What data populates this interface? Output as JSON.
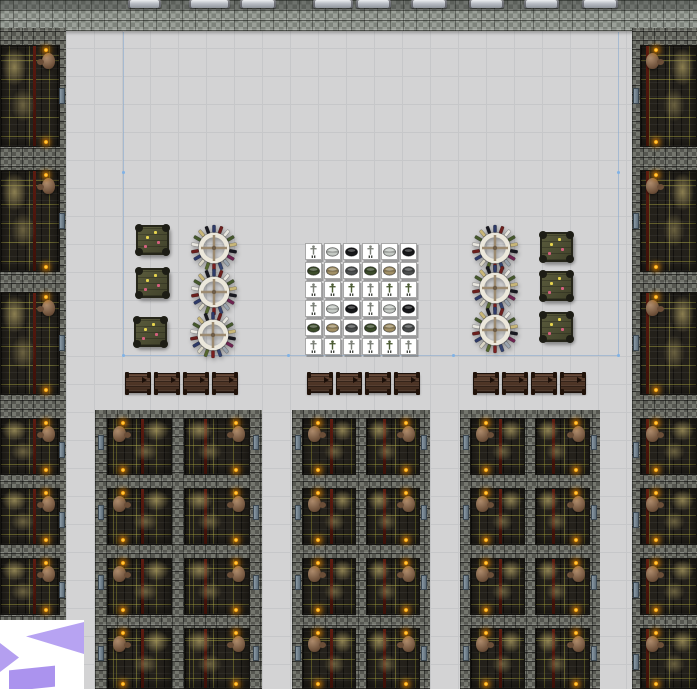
{
  "scene": {
    "width": 697,
    "height": 689,
    "label": "top-down dungeon colony map view"
  },
  "floor": {
    "color": "#d3d3d4",
    "grid_color": "#c6c7c9",
    "grid_step": 28
  },
  "top_wall": {
    "height": 31,
    "dark_cap_height": 10,
    "beams": [
      [
        128,
        33
      ],
      [
        189,
        41
      ],
      [
        240,
        36
      ],
      [
        313,
        40
      ],
      [
        356,
        35
      ],
      [
        411,
        36
      ],
      [
        469,
        35
      ],
      [
        524,
        35
      ],
      [
        582,
        36
      ]
    ]
  },
  "strips": {
    "left": {
      "x": 0,
      "w": 66,
      "interior_x": 0,
      "interior_w": 60,
      "door_x": 59,
      "pot_side": "right",
      "stripe_pct": 56
    },
    "right": {
      "x": 632,
      "w": 65,
      "interior_x": 640,
      "interior_w": 57,
      "door_x": 633,
      "pot_side": "left",
      "stripe_pct": 9
    },
    "rooms": [
      [
        45,
        102
      ],
      [
        170,
        102
      ],
      [
        292,
        103
      ],
      [
        418,
        57
      ],
      [
        488,
        57
      ],
      [
        558,
        57
      ],
      [
        628,
        61
      ]
    ]
  },
  "blocks": {
    "top": 410,
    "rows": [
      [
        418,
        57
      ],
      [
        488,
        57
      ],
      [
        558,
        57
      ],
      [
        628,
        61
      ]
    ],
    "list": [
      {
        "x": 95,
        "w": 167,
        "cols": [
          [
            107,
            65
          ],
          [
            184,
            66
          ]
        ]
      },
      {
        "x": 292,
        "w": 138,
        "cols": [
          [
            302,
            54
          ],
          [
            366,
            54
          ]
        ]
      },
      {
        "x": 460,
        "w": 140,
        "cols": [
          [
            470,
            55
          ],
          [
            535,
            55
          ]
        ]
      }
    ]
  },
  "furniture": {
    "square_tables": [
      [
        152,
        240
      ],
      [
        152,
        283
      ],
      [
        150,
        332
      ],
      [
        556,
        247
      ],
      [
        556,
        286
      ],
      [
        556,
        327
      ]
    ],
    "square_table_size": [
      33,
      30
    ],
    "square_table_dots": [
      [
        0.58,
        0.16,
        "#e6d44e"
      ],
      [
        0.3,
        0.33,
        "#e6d44e"
      ],
      [
        0.68,
        0.55,
        "#d4607e"
      ],
      [
        0.24,
        0.7,
        "#d4607e"
      ]
    ],
    "round_tables": [
      [
        214,
        248
      ],
      [
        214,
        292
      ],
      [
        213,
        335
      ],
      [
        495,
        248
      ],
      [
        495,
        288
      ],
      [
        495,
        330
      ]
    ],
    "round_table_size": 48,
    "benches": {
      "y": 373,
      "w": 26,
      "h": 20,
      "xs": [
        125,
        154,
        183,
        212,
        307,
        336,
        365,
        394,
        473,
        502,
        531,
        560
      ]
    }
  },
  "stockpile": {
    "x": 305,
    "y": 243,
    "tile_pitch": 19,
    "cols": 6,
    "rows": 6,
    "grid": [
      [
        "stand-gray",
        "helm-silver",
        "helm-black",
        "stand-gray",
        "helm-silver",
        "helm-black"
      ],
      [
        "helm-green",
        "helm-tan",
        "helm-gray",
        "helm-green",
        "helm-tan",
        "helm-gray"
      ],
      [
        "stand-gray",
        "stand-green",
        "stand-green",
        "stand-gray",
        "stand-green",
        "stand-green"
      ],
      [
        "stand-gray",
        "helm-silver",
        "helm-black",
        "stand-gray",
        "helm-silver",
        "helm-black"
      ],
      [
        "helm-green",
        "helm-tan",
        "helm-gray",
        "helm-green",
        "helm-tan",
        "helm-gray"
      ],
      [
        "stand-gray",
        "stand-green",
        "stand-gray",
        "stand-gray",
        "stand-green",
        "stand-gray"
      ]
    ]
  },
  "zone": {
    "x1": 123,
    "x2": 618,
    "y_top": 32,
    "y_mid": 172,
    "y_bottom": 355,
    "line_color": "rgba(130,165,205,0.55)",
    "dot_color": "#7fb2e6"
  },
  "logo": {
    "x": 0,
    "y": 620,
    "w": 84,
    "h": 69,
    "bg": "#ffffff",
    "big_triangle_color": "#b7a3f2",
    "small_triangle_color": "#b49ff0",
    "square_color": "#ab93ee"
  },
  "palette": {
    "red_stripe": "#5d1b10",
    "dust": "rgba(166,151,95,0.8)",
    "pot": "#8f6f53",
    "torch": "#ffb200",
    "door": "#7d8c98",
    "ring": "#ebe7db",
    "cross": "#9c8a70",
    "cross_center": "#6d5c47",
    "sticks": [
      "#2e3a68",
      "#6b1f1d",
      "#e8e6df",
      "#45582c",
      "#c8b678",
      "#191920",
      "#6e2450",
      "#9aa4ae",
      "#36446e",
      "#7a1f1f",
      "#55662f",
      "#d8d4c4"
    ],
    "helm": {
      "silver": "#c4c9c4",
      "black": "#17181a",
      "green": "#3c4c2b",
      "tan": "#a08f66",
      "gray": "#4b4e4e"
    },
    "stand": {
      "gray": "#7c8078",
      "green": "#4c5c34"
    },
    "knob": "#1d1d15",
    "bench_post": "#201209"
  }
}
